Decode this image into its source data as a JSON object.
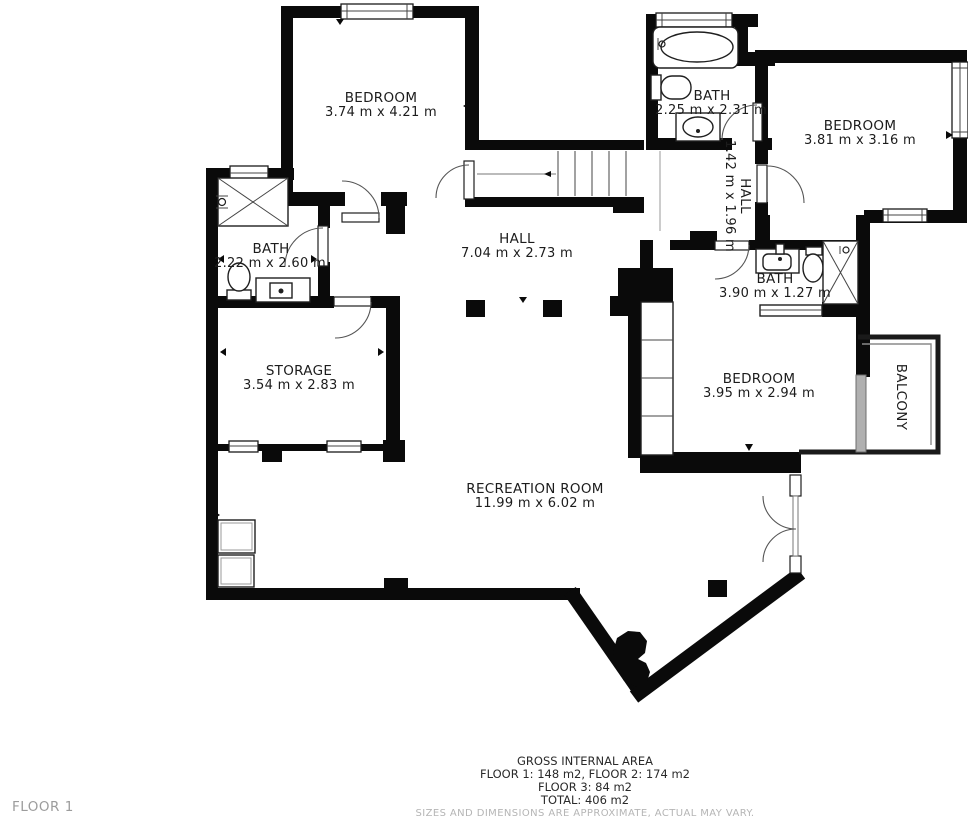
{
  "title": "Floor plan — Floor 1",
  "rooms": [
    {
      "id": "bedroom-1",
      "name": "BEDROOM",
      "dims": "3.74 m x 4.21 m"
    },
    {
      "id": "bath-top",
      "name": "BATH",
      "dims": "2.25 m x 2.31 m"
    },
    {
      "id": "bedroom-2",
      "name": "BEDROOM",
      "dims": "3.81 m x 3.16 m"
    },
    {
      "id": "hall-upper",
      "name": "HALL",
      "dims": "1.42 m x 1.96 m"
    },
    {
      "id": "bath-left",
      "name": "BATH",
      "dims": "2.22 m x 2.60 m"
    },
    {
      "id": "hall-main",
      "name": "HALL",
      "dims": "7.04 m x 2.73 m"
    },
    {
      "id": "bath-right",
      "name": "BATH",
      "dims": "3.90 m x 1.27 m"
    },
    {
      "id": "storage",
      "name": "STORAGE",
      "dims": "3.54 m x 2.83 m"
    },
    {
      "id": "bedroom-3",
      "name": "BEDROOM",
      "dims": "3.95 m x 2.94 m"
    },
    {
      "id": "balcony",
      "name": "BALCONY",
      "dims": ""
    },
    {
      "id": "recreation",
      "name": "RECREATION ROOM",
      "dims": "11.99 m x 6.02 m"
    }
  ],
  "footer": {
    "title": "GROSS INTERNAL AREA",
    "line1": "FLOOR 1: 148 m2, FLOOR 2: 174 m2",
    "line2": "FLOOR 3: 84 m2",
    "line3": "TOTAL: 406 m2",
    "disclaimer": "SIZES AND DIMENSIONS ARE APPROXIMATE, ACTUAL MAY VARY."
  },
  "floor_label": "FLOOR 1",
  "colors": {
    "wall": "#0a0a0a",
    "text": "#1c1c1c",
    "muted": "#b5b5b5",
    "floor_label": "#9c9c9c"
  }
}
